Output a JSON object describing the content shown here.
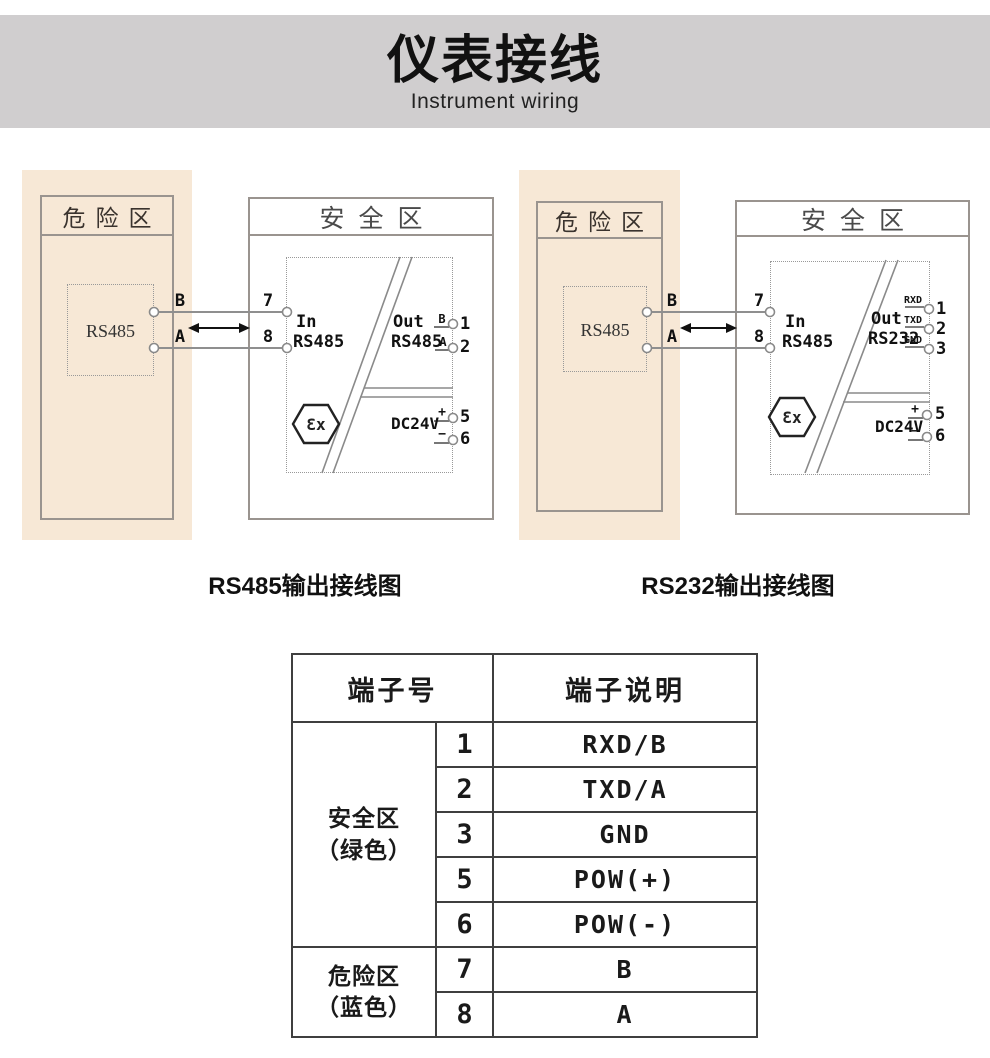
{
  "page": {
    "title": "仪表接线",
    "subtitle": "Instrument wiring"
  },
  "diagrams": [
    {
      "caption": "RS485输出接线图",
      "hazard": {
        "title": "危险区",
        "device": "RS485",
        "b": "B",
        "a": "A"
      },
      "safe": {
        "title": "安全区",
        "in_word": "In",
        "in_bus": "RS485",
        "t7": "7",
        "t8": "8",
        "out_word": "Out",
        "out_bus": "RS485",
        "out_rows": [
          {
            "sig": "B",
            "num": "1"
          },
          {
            "sig": "A",
            "num": "2"
          }
        ],
        "pwr": "DC24V",
        "pwr_rows": [
          {
            "sig": "+",
            "num": "5"
          },
          {
            "sig": "−",
            "num": "6"
          }
        ],
        "ex": "Ɛx"
      }
    },
    {
      "caption": "RS232输出接线图",
      "hazard": {
        "title": "危险区",
        "device": "RS485",
        "b": "B",
        "a": "A"
      },
      "safe": {
        "title": "安全区",
        "in_word": "In",
        "in_bus": "RS485",
        "t7": "7",
        "t8": "8",
        "out_word": "Out",
        "out_bus": "RS232",
        "out_rows": [
          {
            "sig": "RXD",
            "num": "1"
          },
          {
            "sig": "TXD",
            "num": "2"
          },
          {
            "sig": "GND",
            "num": "3"
          }
        ],
        "pwr": "DC24V",
        "pwr_rows": [
          {
            "sig": "+",
            "num": "5"
          },
          {
            "sig": "−",
            "num": "6"
          }
        ],
        "ex": "Ɛx"
      }
    }
  ],
  "terminal_table": {
    "col_terminal": "端子号",
    "col_desc": "端子说明",
    "groups": [
      {
        "zone": "安全区\n（绿色）",
        "rows": [
          [
            "1",
            "RXD/B"
          ],
          [
            "2",
            "TXD/A"
          ],
          [
            "3",
            "GND"
          ],
          [
            "5",
            "POW(+)"
          ],
          [
            "6",
            "POW(-)"
          ]
        ]
      },
      {
        "zone": "危险区\n（蓝色）",
        "rows": [
          [
            "7",
            "B"
          ],
          [
            "8",
            "A"
          ]
        ]
      }
    ]
  },
  "colors": {
    "banner_bg": "#d0cecf",
    "hazard_bg": "#f7e8d6",
    "wire": "#8f8f8f",
    "border_dark": "#3f3f3f",
    "text": "#1a1a1a"
  }
}
